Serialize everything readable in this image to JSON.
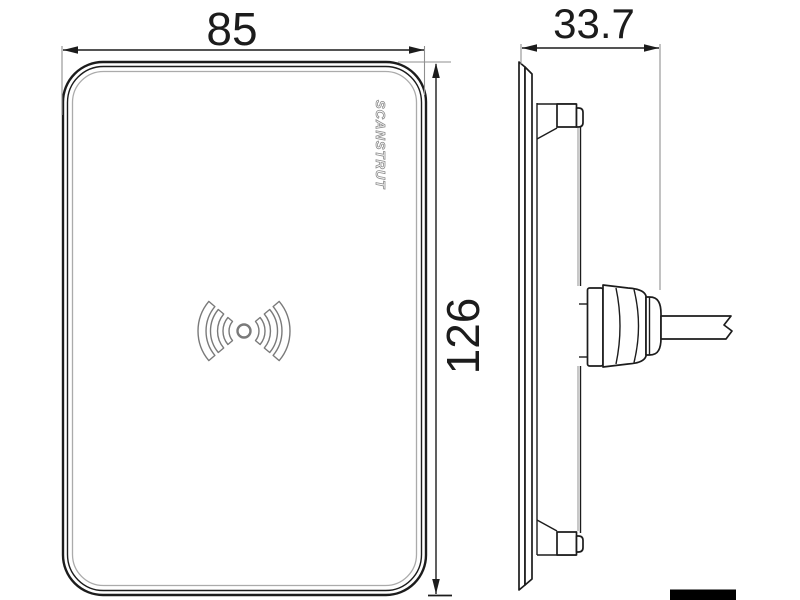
{
  "drawing_type": "technical dimensional drawing, front and side view of wireless charger",
  "branding": {
    "logo_text": "SCANSTRUT"
  },
  "dimensions": {
    "width_mm": "85",
    "height_mm": "126",
    "depth_mm": "33.7"
  },
  "icons": {
    "wireless_charging_icon": "center dot with three concentric signal arcs on each side",
    "scale_bar": "solid black bar, bottom right"
  },
  "colors": {
    "background": "#ffffff",
    "main_line": "#1c1c1c",
    "light_line": "#ababab",
    "scale_bar": "#000000"
  }
}
